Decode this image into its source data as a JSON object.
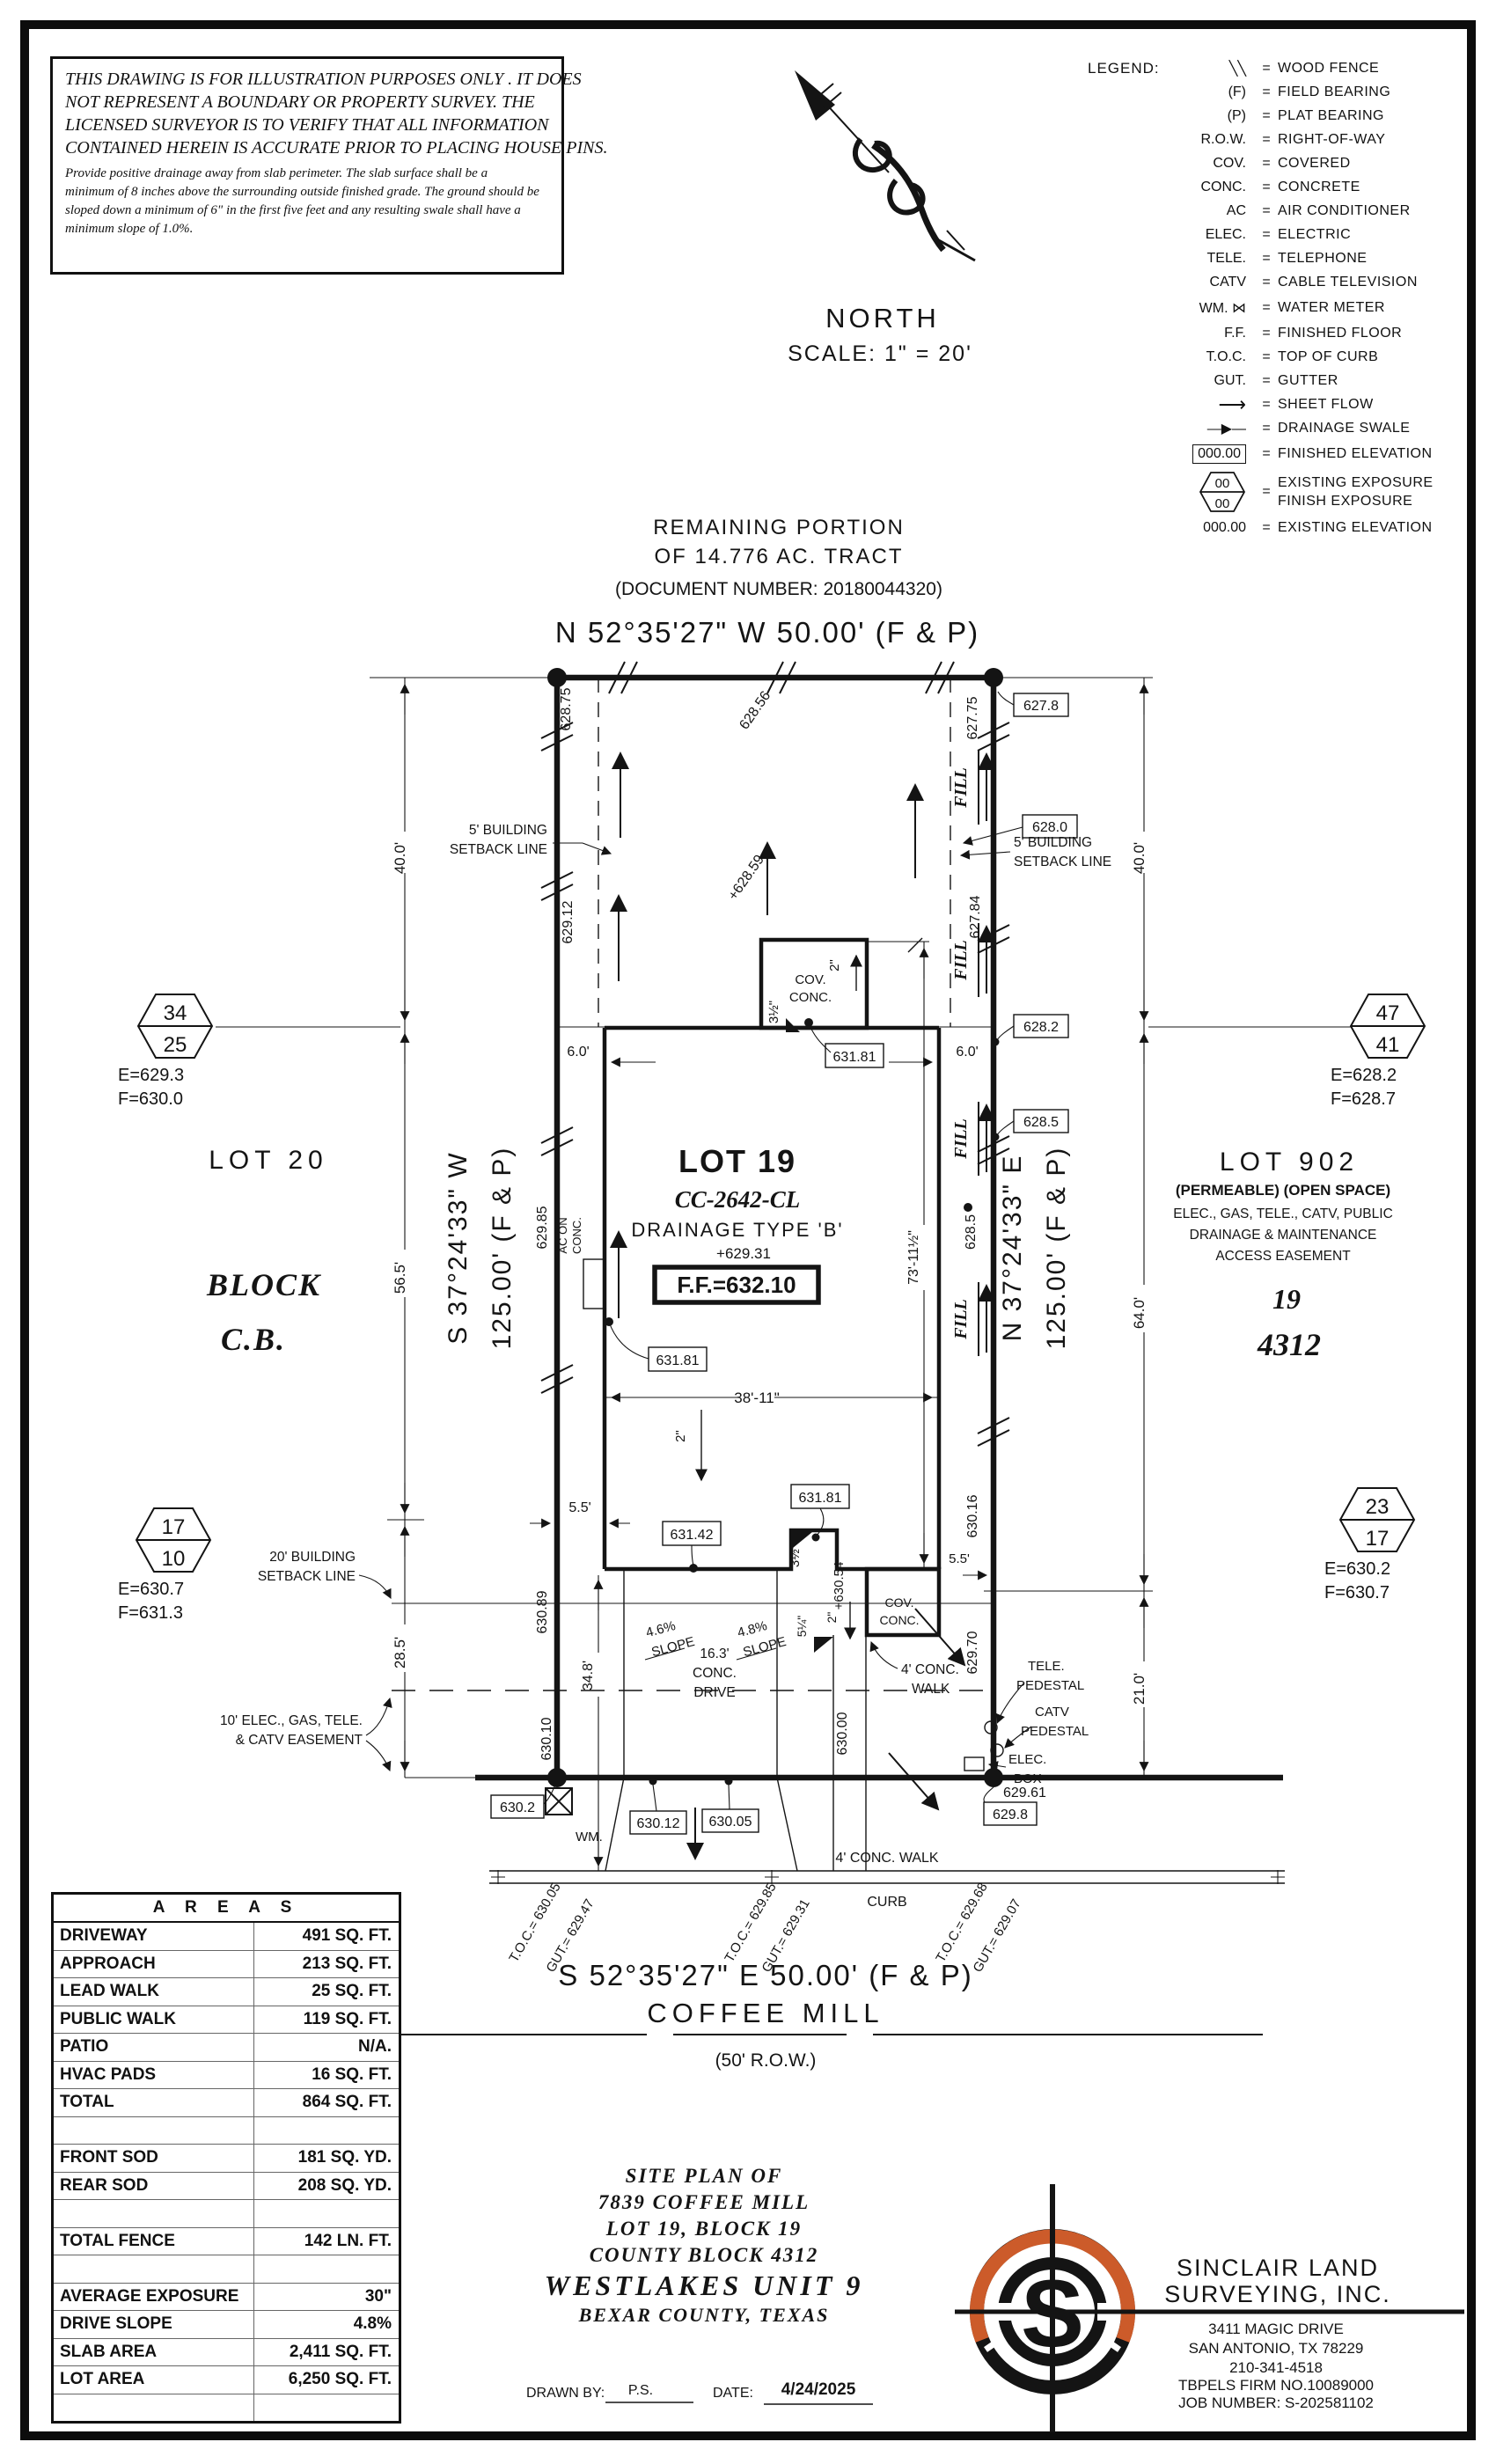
{
  "disclaimer": {
    "p1l1": "THIS DRAWING IS FOR ILLUSTRATION PURPOSES ONLY . IT DOES",
    "p1l2": "NOT REPRESENT A BOUNDARY OR PROPERTY SURVEY. THE",
    "p1l3": "LICENSED SURVEYOR IS TO VERIFY THAT ALL INFORMATION",
    "p1l4": "CONTAINED HEREIN IS ACCURATE PRIOR TO PLACING HOUSE PINS.",
    "p2l1": "Provide positive drainage away from slab perimeter. The slab surface shall be a",
    "p2l2": "minimum of 8 inches above the surrounding outside finished grade. The ground should be",
    "p2l3": "sloped down a minimum of 6\" in the first five feet and any resulting swale shall have a",
    "p2l4": "minimum slope of 1.0%."
  },
  "legend": {
    "title": "LEGEND:",
    "eq": "=",
    "items": [
      {
        "sym": "╲╲",
        "desc": "WOOD FENCE"
      },
      {
        "sym": "(F)",
        "desc": "FIELD BEARING"
      },
      {
        "sym": "(P)",
        "desc": "PLAT BEARING"
      },
      {
        "sym": "R.O.W.",
        "desc": "RIGHT-OF-WAY"
      },
      {
        "sym": "COV.",
        "desc": "COVERED"
      },
      {
        "sym": "CONC.",
        "desc": "CONCRETE"
      },
      {
        "sym": "AC",
        "desc": "AIR CONDITIONER"
      },
      {
        "sym": "ELEC.",
        "desc": "ELECTRIC"
      },
      {
        "sym": "TELE.",
        "desc": "TELEPHONE"
      },
      {
        "sym": "CATV",
        "desc": "CABLE TELEVISION"
      },
      {
        "sym": "WM. ⋈",
        "desc": "WATER METER"
      },
      {
        "sym": "F.F.",
        "desc": "FINISHED FLOOR"
      },
      {
        "sym": "T.O.C.",
        "desc": "TOP OF CURB"
      },
      {
        "sym": "GUT.",
        "desc": "GUTTER"
      },
      {
        "sym": "⟶",
        "desc": "SHEET FLOW"
      },
      {
        "sym": "―▶―",
        "desc": "DRAINAGE SWALE"
      },
      {
        "sym": "000.00",
        "desc": "FINISHED ELEVATION"
      },
      {
        "sym": "",
        "top": "00",
        "bottom": "00",
        "desc1": "EXISTING EXPOSURE",
        "desc2": "FINISH EXPOSURE"
      },
      {
        "sym": "000.00",
        "desc": "EXISTING ELEVATION"
      }
    ]
  },
  "north_arrow": {
    "label": "NORTH",
    "scale": "SCALE: 1\" = 20'"
  },
  "context": {
    "line1": "REMAINING PORTION",
    "line2": "OF 14.776 AC. TRACT",
    "line3": "(DOCUMENT NUMBER: 20180044320)"
  },
  "bearings": {
    "north": "N 52°35'27\" W 50.00' (F & P)",
    "south": "S 52°35'27\" E 50.00' (F & P)",
    "west1": "S 37°24'33\" W",
    "west2": "125.00' (F & P)",
    "east1": "N 37°24'33\" E",
    "east2": "125.00' (F & P)"
  },
  "plot": {
    "setback5a": "5' BUILDING",
    "setback5b": "SETBACK LINE",
    "setback20a": "20' BUILDING",
    "setback20b": "SETBACK LINE",
    "easement10a": "10' ELEC., GAS, TELE.",
    "easement10b": "& CATV EASEMENT",
    "dims": {
      "d40": "40.0'",
      "d56": "56.5'",
      "d28": "28.5'",
      "d64": "64.0'",
      "d21": "21.0'",
      "d34": "34.8'",
      "d38": "38'-11\"",
      "d73": "73'-11½\"",
      "d6l": "6.0'",
      "d6r": "6.0'",
      "d55f": "5.5'",
      "d55r": "5.5'"
    },
    "elev": {
      "e62875": "628.75",
      "e62912": "629.12",
      "e62985": "629.85",
      "e63089": "630.89",
      "e63010": "630.10",
      "e62775": "627.75",
      "e62784": "627.84",
      "e6285": "628.5",
      "e63016": "630.16",
      "e62970": "629.70",
      "e62856": "628.56",
      "e62859": "+628.59",
      "e63054": "+630.54",
      "e63000": "630.00",
      "e62961": "629.61"
    },
    "boxes": {
      "b6278": "627.8",
      "b6280": "628.0",
      "b6282": "628.2",
      "b6285": "628.5",
      "b63181a": "631.81",
      "b63181b": "631.81",
      "b63181c": "631.81",
      "b63142": "631.42",
      "b6302": "630.2",
      "b63012": "630.12",
      "b63005": "630.05",
      "b6298": "629.8"
    },
    "house": {
      "lot": "LOT 19",
      "plan": "CC-2642-CL",
      "drainage": "DRAINAGE TYPE 'B'",
      "pad": "+629.31",
      "ff": "F.F.=632.10"
    },
    "cov_rear1": "COV.",
    "cov_rear2": "CONC.",
    "cov_front1": "COV.",
    "cov_front2": "CONC.",
    "fill": "FILL",
    "ac1": "AC ON",
    "ac2": "CONC.",
    "small": {
      "s2house": "2\"",
      "s2patio": "2\"",
      "s2porch": "2\"",
      "s35rear": "3½\"",
      "s35front": "3½\"",
      "s5q": "5¼\""
    },
    "slope46": "4.6%",
    "slope48": "4.8%",
    "slopew1": "SLOPE",
    "slopew2": "SLOPE",
    "drive1": "16.3'",
    "drive2": "CONC.",
    "drive3": "DRIVE",
    "walk1": "4' CONC.",
    "walk2": "WALK",
    "wm": "WM.",
    "tele1": "TELE.",
    "tele2": "PEDESTAL",
    "catv1": "CATV",
    "catv2": "PEDESTAL",
    "elec1": "ELEC.",
    "elec2": "BOX",
    "lot20": "LOT 20",
    "block1": "BLOCK",
    "block2": "C.B.",
    "lot902": "LOT 902",
    "perm": "(PERMEABLE) (OPEN SPACE)",
    "ease1": "ELEC., GAS, TELE., CATV, PUBLIC",
    "ease2": "DRAINAGE & MAINTENANCE",
    "ease3": "ACCESS EASEMENT",
    "blk19": "19",
    "blk4312": "4312",
    "hex1": {
      "t": "34",
      "b": "25",
      "e": "E=629.3",
      "f": "F=630.0"
    },
    "hex2": {
      "t": "47",
      "b": "41",
      "e": "E=628.2",
      "f": "F=628.7"
    },
    "hex3": {
      "t": "17",
      "b": "10",
      "e": "E=630.7",
      "f": "F=631.3"
    },
    "hex4": {
      "t": "23",
      "b": "17",
      "e": "E=630.2",
      "f": "F=630.7"
    }
  },
  "street": {
    "walk": "4' CONC. WALK",
    "curb": "CURB",
    "name": "COFFEE MILL",
    "row": "(50' R.O.W.)",
    "toc1a": "T.O.C.= 630.05",
    "toc1b": "GUT.= 629.47",
    "toc2a": "T.O.C.= 629.85",
    "toc2b": "GUT.= 629.31",
    "toc3a": "T.O.C.= 629.68",
    "toc3b": "GUT.= 629.07"
  },
  "areas": {
    "title": "A R E A S",
    "rows": [
      {
        "l": "DRIVEWAY",
        "v": "491 SQ. FT."
      },
      {
        "l": "APPROACH",
        "v": "213 SQ. FT."
      },
      {
        "l": "LEAD WALK",
        "v": "25 SQ. FT."
      },
      {
        "l": "PUBLIC WALK",
        "v": "119 SQ. FT."
      },
      {
        "l": "PATIO",
        "v": "N/A."
      },
      {
        "l": "HVAC PADS",
        "v": "16 SQ. FT."
      },
      {
        "l": "TOTAL",
        "v": "864 SQ. FT."
      },
      {
        "l": "",
        "v": ""
      },
      {
        "l": "FRONT SOD",
        "v": "181 SQ. YD."
      },
      {
        "l": "REAR SOD",
        "v": "208 SQ. YD."
      },
      {
        "l": "",
        "v": ""
      },
      {
        "l": "TOTAL FENCE",
        "v": "142 LN. FT."
      },
      {
        "l": "",
        "v": ""
      },
      {
        "l": "AVERAGE EXPOSURE",
        "v": "30\""
      },
      {
        "l": "DRIVE SLOPE",
        "v": "4.8%"
      },
      {
        "l": "SLAB AREA",
        "v": "2,411 SQ. FT."
      },
      {
        "l": "LOT AREA",
        "v": "6,250 SQ. FT."
      },
      {
        "l": "",
        "v": ""
      }
    ]
  },
  "titleblock": {
    "l1": "SITE PLAN OF",
    "l2": "7839 COFFEE MILL",
    "l3": "LOT 19, BLOCK 19",
    "l4": "COUNTY BLOCK 4312",
    "l5": "WESTLAKES UNIT 9",
    "l6": "BEXAR COUNTY, TEXAS",
    "drawn": "DRAWN BY:",
    "drawn_val": "P.S.",
    "date": "DATE:",
    "date_val": "4/24/2025"
  },
  "company": {
    "s": "S",
    "n1": "SINCLAIR LAND",
    "n2": "SURVEYING, INC.",
    "a1": "3411 MAGIC DRIVE",
    "a2": "SAN ANTONIO, TX 78229",
    "a3": "210-341-4518",
    "a4": "TBPELS FIRM NO.10089000",
    "a5": "JOB NUMBER: S-202581102"
  },
  "colors": {
    "accent": "#CC5B2A",
    "ink": "#141414"
  }
}
